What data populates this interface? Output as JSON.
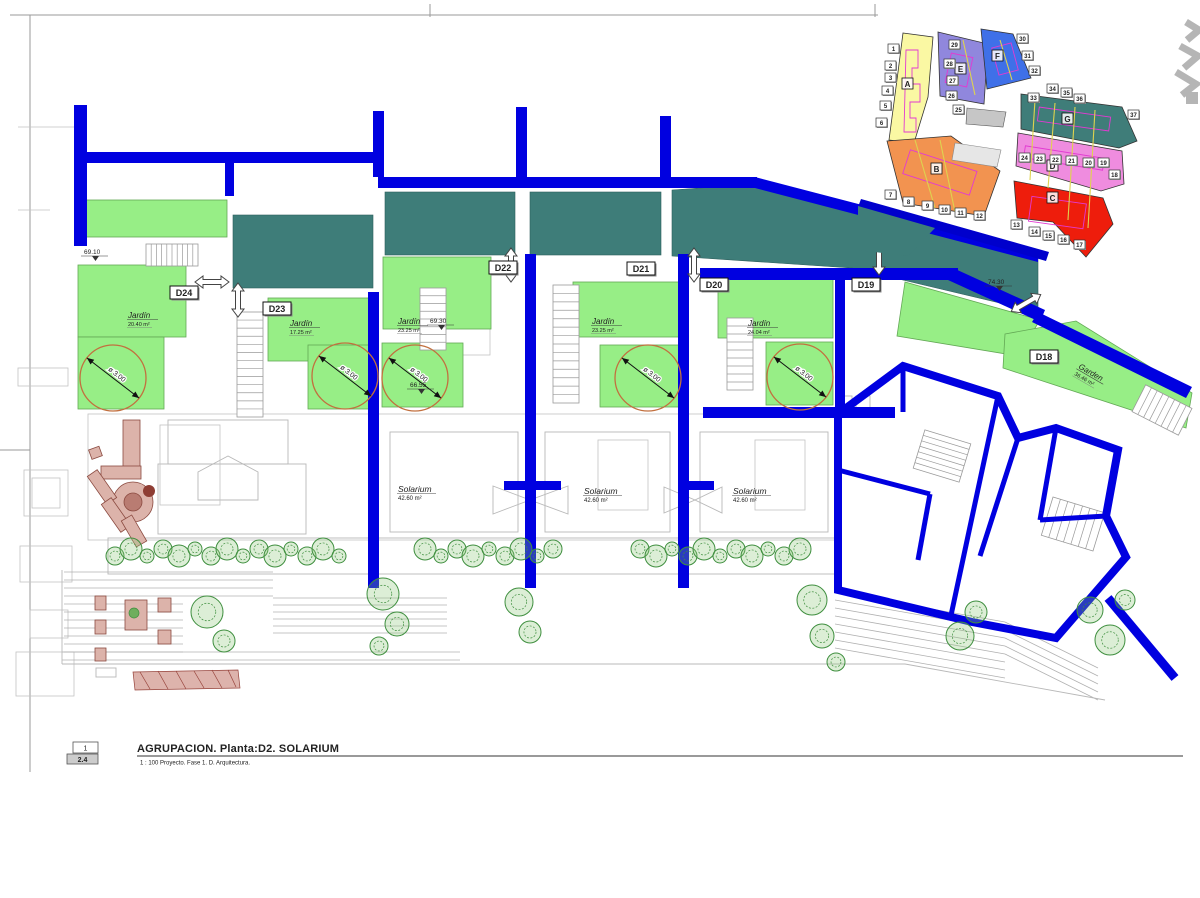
{
  "title_block": {
    "ref_top": "1",
    "ref_bottom": "2.4",
    "title": "AGRUPACION. Planta:D2. SOLARIUM",
    "subtitle": "1 : 100 Proyecto. Fase 1. D. Arquitectura."
  },
  "colors": {
    "wall_blue": "#0000E0",
    "roof_teal": "#3E7D79",
    "garden_green": "#97EE86",
    "dim_circle": "#C2703F",
    "keymap_sea": "#0000CC",
    "tree_green": "#3F8F3F",
    "furniture_red": "#8B4A40"
  },
  "plan": {
    "unit_labels": [
      {
        "id": "D24",
        "x": 170,
        "y": 286
      },
      {
        "id": "D23",
        "x": 263,
        "y": 302
      },
      {
        "id": "D22",
        "x": 489,
        "y": 261
      },
      {
        "id": "D21",
        "x": 627,
        "y": 262
      },
      {
        "id": "D20",
        "x": 700,
        "y": 278
      },
      {
        "id": "D19",
        "x": 852,
        "y": 278
      },
      {
        "id": "D18",
        "x": 1030,
        "y": 350
      }
    ],
    "garden_labels": [
      {
        "text": "Jardín",
        "area": "20.40 m²",
        "x": 128,
        "y": 318,
        "rotate": 0
      },
      {
        "text": "Jardín",
        "area": "17.25 m²",
        "x": 290,
        "y": 326,
        "rotate": 0
      },
      {
        "text": "Jardín",
        "area": "23.25 m²",
        "x": 398,
        "y": 324,
        "rotate": 0
      },
      {
        "text": "Jardín",
        "area": "23.25 m²",
        "x": 592,
        "y": 324,
        "rotate": 0
      },
      {
        "text": "Jardín",
        "area": "24.04 m²",
        "x": 748,
        "y": 326,
        "rotate": 0
      },
      {
        "text": "Garden",
        "area": "36.46 m²",
        "x": 1078,
        "y": 368,
        "rotate": 30
      }
    ],
    "solarium_labels": [
      {
        "text": "Solarium",
        "area": "42.60 m²",
        "x": 398,
        "y": 492
      },
      {
        "text": "Solarium",
        "area": "42.60 m²",
        "x": 584,
        "y": 494
      },
      {
        "text": "Solarium",
        "area": "42.60 m²",
        "x": 733,
        "y": 494
      }
    ],
    "level_markers": [
      {
        "value": "69.10",
        "x": 84,
        "y": 254
      },
      {
        "value": "69.30",
        "x": 430,
        "y": 323
      },
      {
        "value": "74.30",
        "x": 988,
        "y": 284
      },
      {
        "value": "66.55",
        "x": 410,
        "y": 387
      }
    ],
    "circle_dimensions": [
      {
        "label": "ø 3.00",
        "cx": 113,
        "cy": 378,
        "r": 33
      },
      {
        "label": "ø 3.00",
        "cx": 345,
        "cy": 376,
        "r": 33
      },
      {
        "label": "ø 3.00",
        "cx": 415,
        "cy": 378,
        "r": 33
      },
      {
        "label": "ø 3.00",
        "cx": 648,
        "cy": 378,
        "r": 33
      },
      {
        "label": "ø 3.00",
        "cx": 800,
        "cy": 377,
        "r": 33
      }
    ]
  },
  "keymap": {
    "zones": [
      {
        "letter": "A",
        "color": "#FAF8A3",
        "lx": 907,
        "ly": 86
      },
      {
        "letter": "B",
        "color": "#F29350",
        "lx": 936,
        "ly": 171
      },
      {
        "letter": "C",
        "color": "#EE1D0C",
        "lx": 1052,
        "ly": 200
      },
      {
        "letter": "D",
        "color": "#EF8CDF",
        "lx": 1052,
        "ly": 168
      },
      {
        "letter": "E",
        "color": "#9087DD",
        "lx": 960,
        "ly": 71
      },
      {
        "letter": "F",
        "color": "#3F70E8",
        "lx": 997,
        "ly": 58
      },
      {
        "letter": "G",
        "color": "#3F7D79",
        "lx": 1067,
        "ly": 121
      }
    ],
    "lot_numbers": [
      {
        "n": "1",
        "x": 888,
        "y": 44
      },
      {
        "n": "2",
        "x": 885,
        "y": 61
      },
      {
        "n": "3",
        "x": 885,
        "y": 73
      },
      {
        "n": "4",
        "x": 882,
        "y": 86
      },
      {
        "n": "5",
        "x": 880,
        "y": 101
      },
      {
        "n": "6",
        "x": 876,
        "y": 118
      },
      {
        "n": "7",
        "x": 885,
        "y": 190
      },
      {
        "n": "8",
        "x": 903,
        "y": 197
      },
      {
        "n": "9",
        "x": 922,
        "y": 201
      },
      {
        "n": "10",
        "x": 939,
        "y": 205
      },
      {
        "n": "11",
        "x": 955,
        "y": 208
      },
      {
        "n": "12",
        "x": 974,
        "y": 211
      },
      {
        "n": "13",
        "x": 1011,
        "y": 220
      },
      {
        "n": "14",
        "x": 1029,
        "y": 227
      },
      {
        "n": "15",
        "x": 1043,
        "y": 231
      },
      {
        "n": "16",
        "x": 1058,
        "y": 235
      },
      {
        "n": "17",
        "x": 1074,
        "y": 240
      },
      {
        "n": "18",
        "x": 1109,
        "y": 170
      },
      {
        "n": "19",
        "x": 1098,
        "y": 158
      },
      {
        "n": "20",
        "x": 1083,
        "y": 158
      },
      {
        "n": "21",
        "x": 1066,
        "y": 156
      },
      {
        "n": "22",
        "x": 1050,
        "y": 155
      },
      {
        "n": "23",
        "x": 1034,
        "y": 154
      },
      {
        "n": "24",
        "x": 1019,
        "y": 153
      },
      {
        "n": "25",
        "x": 953,
        "y": 105
      },
      {
        "n": "26",
        "x": 946,
        "y": 91
      },
      {
        "n": "27",
        "x": 947,
        "y": 76
      },
      {
        "n": "28",
        "x": 944,
        "y": 59
      },
      {
        "n": "29",
        "x": 949,
        "y": 40
      },
      {
        "n": "30",
        "x": 1017,
        "y": 34
      },
      {
        "n": "31",
        "x": 1022,
        "y": 51
      },
      {
        "n": "32",
        "x": 1029,
        "y": 66
      },
      {
        "n": "33",
        "x": 1028,
        "y": 93
      },
      {
        "n": "34",
        "x": 1047,
        "y": 84
      },
      {
        "n": "35",
        "x": 1061,
        "y": 88
      },
      {
        "n": "36",
        "x": 1074,
        "y": 94
      },
      {
        "n": "37",
        "x": 1128,
        "y": 110
      }
    ]
  }
}
